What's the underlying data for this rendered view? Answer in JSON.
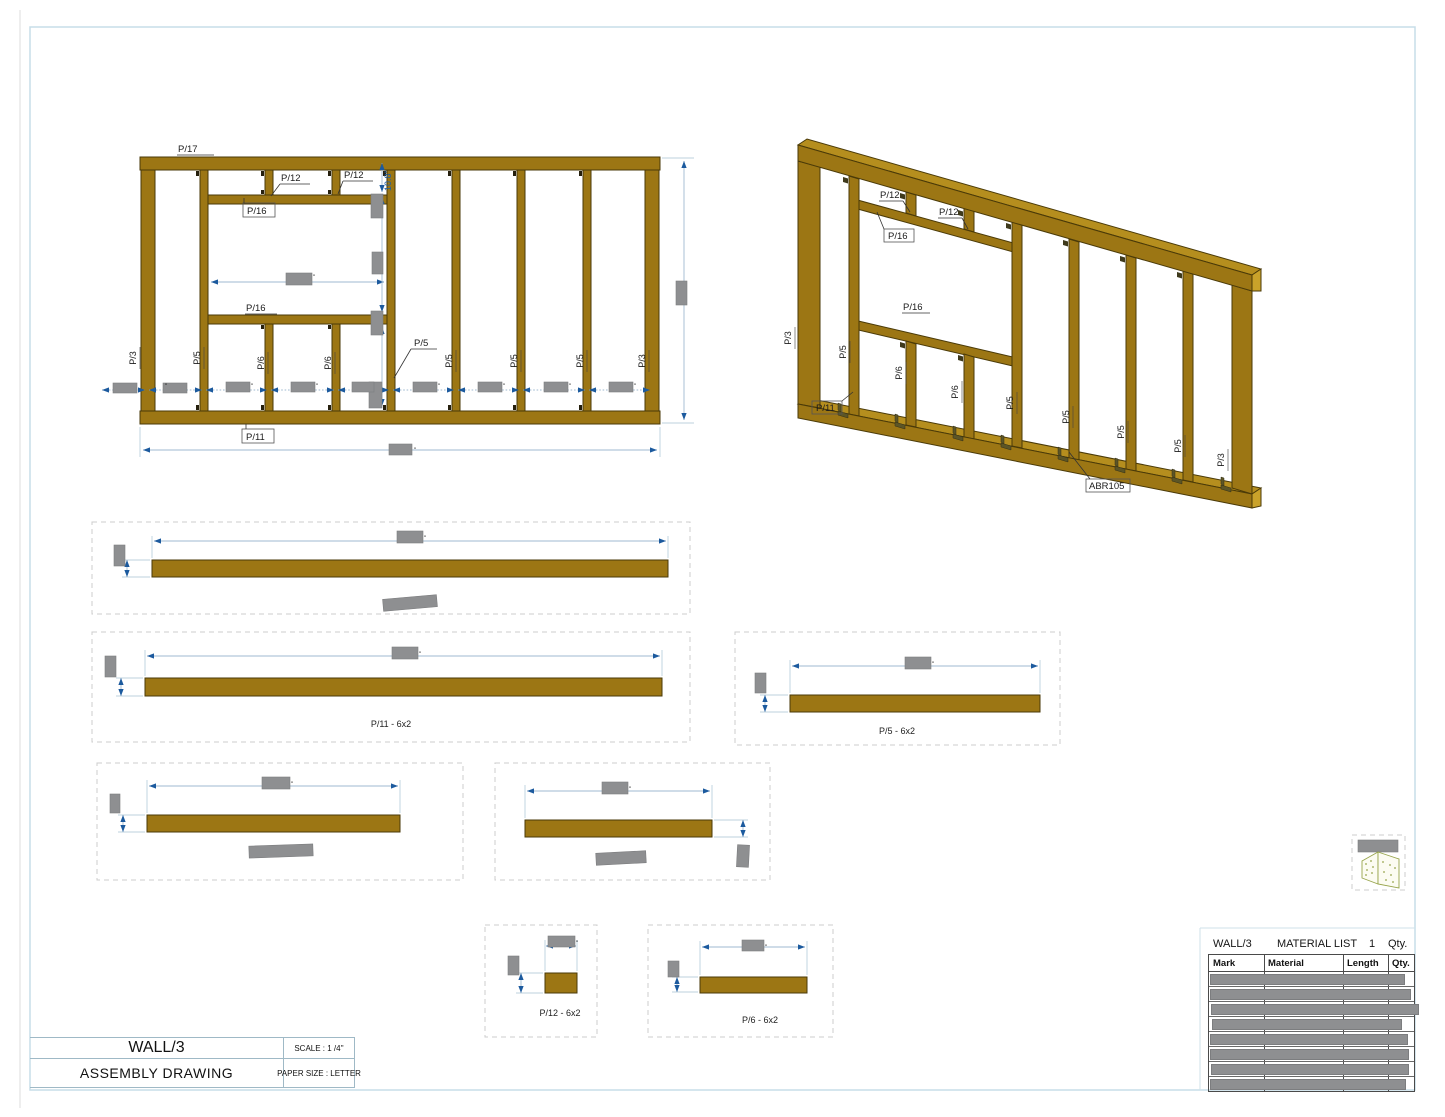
{
  "front_view": {
    "label_p17": "P/17",
    "label_p12_a": "P/12",
    "label_p12_b": "P/12",
    "label_p16_top": "P/16",
    "label_p16_sill": "P/16",
    "label_p5_callout": "P/5",
    "label_p11": "P/11",
    "dim_10_8": "10.8\"",
    "stud_labels": [
      "P/3",
      "P/5",
      "P/6",
      "P/6",
      "P/5",
      "P/5",
      "P/5",
      "P/3"
    ]
  },
  "iso_view": {
    "label_p12_a": "P/12",
    "label_p12_b": "P/12",
    "label_p16_top": "P/16",
    "label_p16_mid": "P/16",
    "label_p11": "P/11",
    "label_abr": "ABR105",
    "stud_labels": [
      "P/3",
      "P/5",
      "P/6",
      "P/6",
      "P/5",
      "P/5",
      "P/5",
      "P/5",
      "P/3"
    ]
  },
  "details": {
    "p11": "P/11  -  6x2",
    "p5": "P/5  -  6x2",
    "p12": "P/12  -  6x2",
    "p6": "P/6  -  6x2"
  },
  "material_list": {
    "panel": "WALL/3",
    "title": "MATERIAL LIST",
    "count": "1",
    "qty": "Qty.",
    "col_mark": "Mark",
    "col_material": "Material",
    "col_length": "Length",
    "col_qty": "Qty."
  },
  "title_block": {
    "name": "WALL/3",
    "type": "ASSEMBLY DRAWING",
    "scale": "SCALE : 1 /4''",
    "paper": "PAPER SIZE : LETTER"
  }
}
